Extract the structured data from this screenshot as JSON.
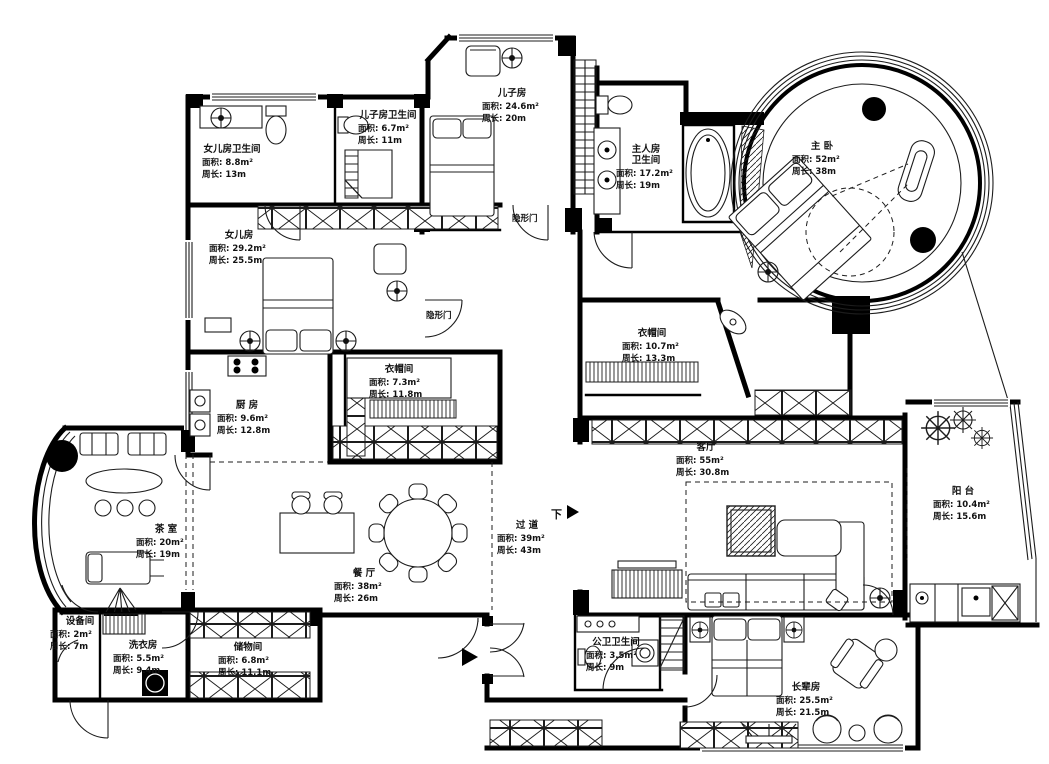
{
  "labels": {
    "area_prefix": "面积: ",
    "perimeter_prefix": "周长: "
  },
  "rooms": [
    {
      "id": "daughter-bathroom",
      "name": "女儿房卫生间",
      "area": "8.8m²",
      "perimeter": "13m",
      "x": 232,
      "y": 152
    },
    {
      "id": "son-bathroom",
      "name": "儿子房卫生间",
      "area": "6.7m²",
      "perimeter": "11m",
      "x": 388,
      "y": 118
    },
    {
      "id": "son-room",
      "name": "儿子房",
      "area": "24.6m²",
      "perimeter": "20m",
      "x": 512,
      "y": 96
    },
    {
      "id": "master-bathroom",
      "name": "主人房",
      "name2": "卫生间",
      "area": "17.2m²",
      "perimeter": "19m",
      "x": 646,
      "y": 152
    },
    {
      "id": "master-bedroom",
      "name": "主 卧",
      "area": "52m²",
      "perimeter": "38m",
      "x": 822,
      "y": 149
    },
    {
      "id": "daughter-room",
      "name": "女儿房",
      "area": "29.2m²",
      "perimeter": "25.5m",
      "x": 239,
      "y": 238
    },
    {
      "id": "cloakroom-north",
      "name": "衣帽间",
      "area": "7.3m²",
      "perimeter": "11.8m",
      "x": 399,
      "y": 372
    },
    {
      "id": "cloakroom-master",
      "name": "衣帽间",
      "area": "10.7m²",
      "perimeter": "13.3m",
      "x": 652,
      "y": 336
    },
    {
      "id": "kitchen",
      "name": "厨 房",
      "area": "9.6m²",
      "perimeter": "12.8m",
      "x": 247,
      "y": 408
    },
    {
      "id": "living-room",
      "name": "客厅",
      "area": "55m²",
      "perimeter": "30.8m",
      "x": 706,
      "y": 450
    },
    {
      "id": "tea-room",
      "name": "茶 室",
      "area": "20m²",
      "perimeter": "19m",
      "x": 166,
      "y": 532
    },
    {
      "id": "corridor",
      "name": "过 道",
      "area": "39m²",
      "perimeter": "43m",
      "x": 527,
      "y": 528
    },
    {
      "id": "balcony",
      "name": "阳 台",
      "area": "10.4m²",
      "perimeter": "15.6m",
      "x": 963,
      "y": 494
    },
    {
      "id": "dining-room",
      "name": "餐 厅",
      "area": "38m²",
      "perimeter": "26m",
      "x": 364,
      "y": 576
    },
    {
      "id": "equipment-room",
      "name": "设备间",
      "area": "2m²",
      "perimeter": "7m",
      "x": 80,
      "y": 624
    },
    {
      "id": "laundry-room",
      "name": "洗衣房",
      "area": "5.5m²",
      "perimeter": "9.4m",
      "x": 143,
      "y": 648
    },
    {
      "id": "storage-room",
      "name": "储物间",
      "area": "6.8m²",
      "perimeter": "11.1m",
      "x": 248,
      "y": 650
    },
    {
      "id": "public-bathroom",
      "name": "公卫卫生间",
      "area": "3.5m²",
      "perimeter": "9m",
      "x": 616,
      "y": 645
    },
    {
      "id": "elder-room",
      "name": "长辈房",
      "area": "25.5m²",
      "perimeter": "21.5m",
      "x": 806,
      "y": 690
    }
  ],
  "annotations": [
    {
      "id": "hidden-door-north",
      "text": "隐形门",
      "x": 512,
      "y": 221
    },
    {
      "id": "hidden-door-west",
      "text": "隐形门",
      "x": 426,
      "y": 318
    },
    {
      "id": "stairs-down",
      "text": "下",
      "x": 551,
      "y": 518
    }
  ],
  "colors": {
    "wall": "#000000",
    "line": "#1c1c1c",
    "background": "#ffffff",
    "text": "#111111"
  }
}
